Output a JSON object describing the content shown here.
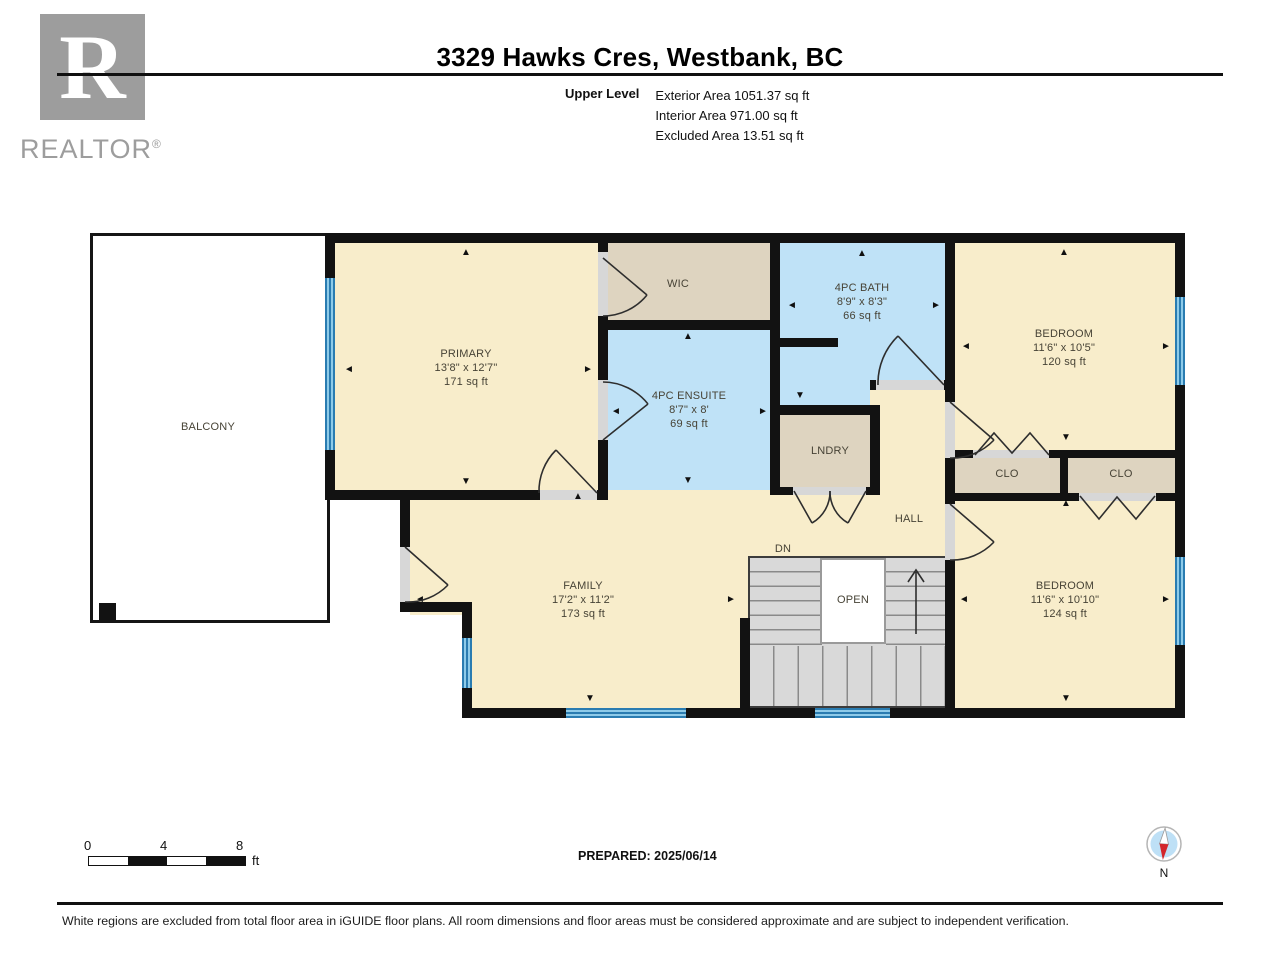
{
  "header": {
    "title": "3329 Hawks Cres, Westbank, BC",
    "level_label": "Upper Level",
    "area_lines": [
      "Exterior Area 1051.37 sq ft",
      "Interior Area 971.00 sq ft",
      "Excluded Area 13.51 sq ft"
    ],
    "logo": {
      "r": "R",
      "word": "REALTOR",
      "reg": "®"
    }
  },
  "rooms": {
    "balcony": {
      "name": "BALCONY"
    },
    "primary": {
      "name": "PRIMARY",
      "dims": "13'8\" x 12'7\"",
      "area": "171 sq ft"
    },
    "wic": {
      "name": "WIC"
    },
    "ensuite": {
      "name": "4PC ENSUITE",
      "dims": "8'7\" x 8'",
      "area": "69 sq ft"
    },
    "bath": {
      "name": "4PC BATH",
      "dims": "8'9\" x 8'3\"",
      "area": "66 sq ft"
    },
    "lndry": {
      "name": "LNDRY"
    },
    "bedroom1": {
      "name": "BEDROOM",
      "dims": "11'6\" x 10'5\"",
      "area": "120 sq ft"
    },
    "clo1": {
      "name": "CLO"
    },
    "clo2": {
      "name": "CLO"
    },
    "bedroom2": {
      "name": "BEDROOM",
      "dims": "11'6\" x 10'10\"",
      "area": "124 sq ft"
    },
    "family": {
      "name": "FAMILY",
      "dims": "17'2\" x 11'2\"",
      "area": "173 sq ft"
    },
    "hall": {
      "name": "HALL"
    }
  },
  "stairs": {
    "dn_label": "DN",
    "open_label": "OPEN"
  },
  "footer": {
    "scale_ticks": [
      "0",
      "4",
      "8"
    ],
    "scale_unit": "ft",
    "prepared": "PREPARED: 2025/06/14",
    "compass_n": "N",
    "disclaimer": "White regions are excluded from total floor area in iGUIDE floor plans. All room dimensions and floor areas must be considered approximate and are subject to independent verification."
  },
  "colors": {
    "wall": "#121212",
    "room_cream": "#F8EDCB",
    "room_tan": "#DED4C0",
    "room_blue": "#BFE2F7",
    "window_blue": "#4D9ECC",
    "stair_gray": "#D9D9D9",
    "compass_red": "#D3262B",
    "logo_gray": "#9D9D9D"
  }
}
